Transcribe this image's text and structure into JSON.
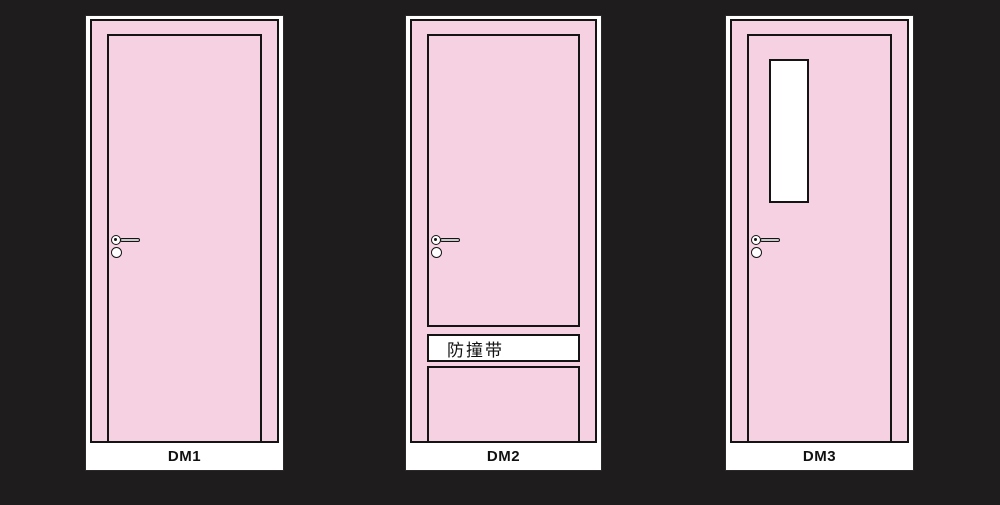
{
  "diagram_title": "door-type-elevations",
  "colors": {
    "background": "#1E1C1C",
    "door_fill": "#F6D1E2",
    "outline": "#141414",
    "surround": "#FFFFFF",
    "handle_bar": "#C9C9C9"
  },
  "doors": [
    {
      "label": "DM1",
      "type": "flush-door",
      "features": [
        "lever-handle"
      ]
    },
    {
      "label": "DM2",
      "type": "door-with-anti-collision-strip",
      "strip_label": "防撞带",
      "features": [
        "lever-handle",
        "anti-collision-strip",
        "lower-panel"
      ]
    },
    {
      "label": "DM3",
      "type": "door-with-vision-panel",
      "features": [
        "lever-handle",
        "vision-panel-window"
      ]
    }
  ]
}
